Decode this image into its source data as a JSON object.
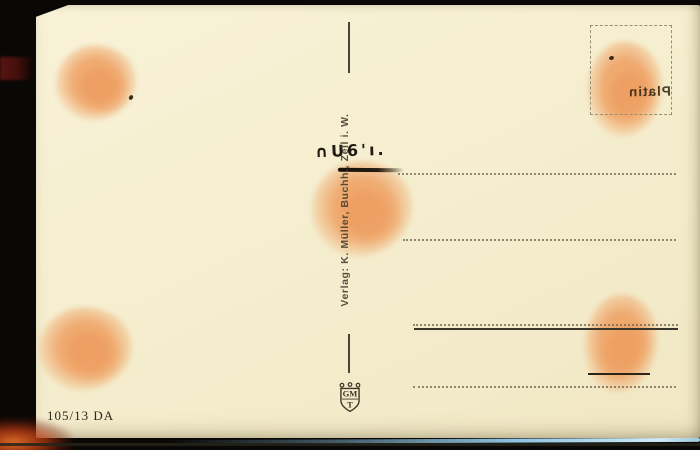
{
  "postcard": {
    "publisher_line": "Verlag: K. Müller, Buchh., Zell i. W.",
    "plate_number": "105/13 DA",
    "handstamp_fragment": "∩U6'ı.",
    "stamp_box": {
      "mirrored_text": "Platin"
    },
    "emblem": {
      "letters_top": "GM",
      "letter_bottom": "T"
    },
    "colors": {
      "background": "#0a0806",
      "card": "#f5eecf",
      "smudge_orange": "#ee9e60",
      "ink_black": "#17100a",
      "imprint_gray": "#4a4131",
      "dotted_line": "#6f6650",
      "red_band": "#5a1410",
      "cyan_streak": "#8fc3de",
      "flare_orange": "#e66e28"
    }
  }
}
